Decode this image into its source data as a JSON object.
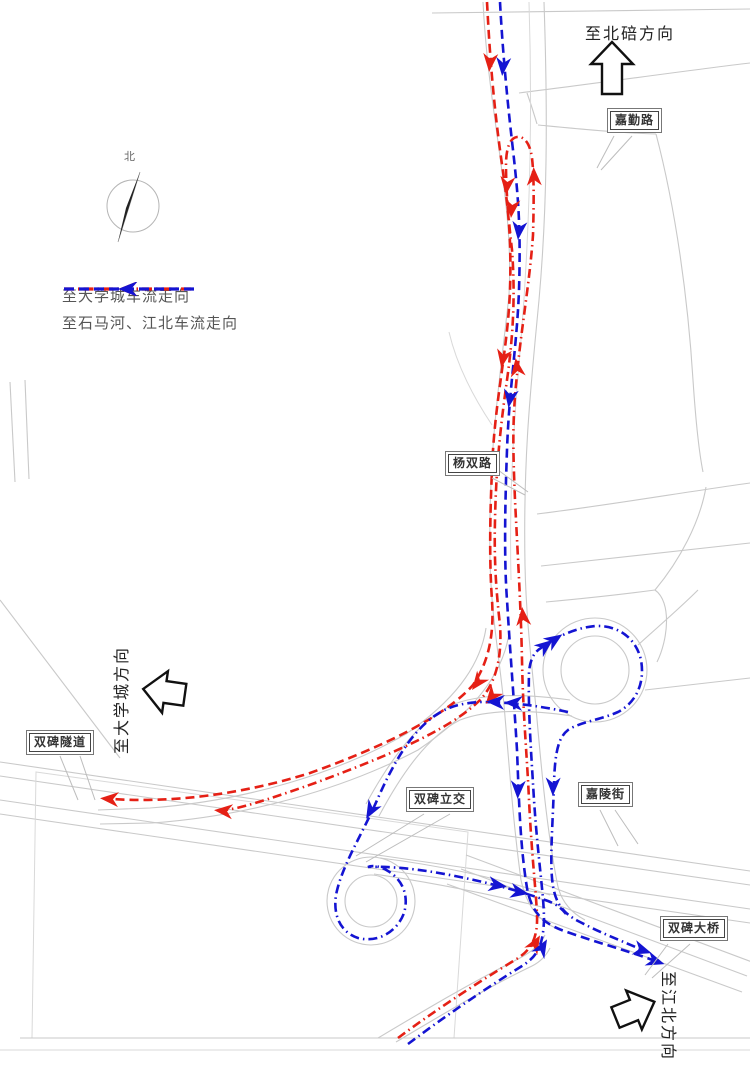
{
  "legend": {
    "items": [
      {
        "id": "to-university-city",
        "label": "至大学城车流走向",
        "color": "#e52015",
        "line_style": "dash-dot"
      },
      {
        "id": "to-shimahe-jiangbei",
        "label": "至石马河、江北车流走向",
        "color": "#1414d2",
        "line_style": "dashed"
      }
    ]
  },
  "direction_signs": {
    "north": "至北碚方向",
    "west": "至大学城方向",
    "southeast": "至江北方向"
  },
  "compass": {
    "label": "北"
  },
  "road_labels": {
    "jiaqin_road": "嘉勤路",
    "yangshuang_road": "杨双路",
    "shuangbei_tunnel": "双碑隧道",
    "shuangbei_interchange": "双碑立交",
    "jialing_street": "嘉陵街",
    "shuangbei_bridge": "双碑大桥"
  }
}
